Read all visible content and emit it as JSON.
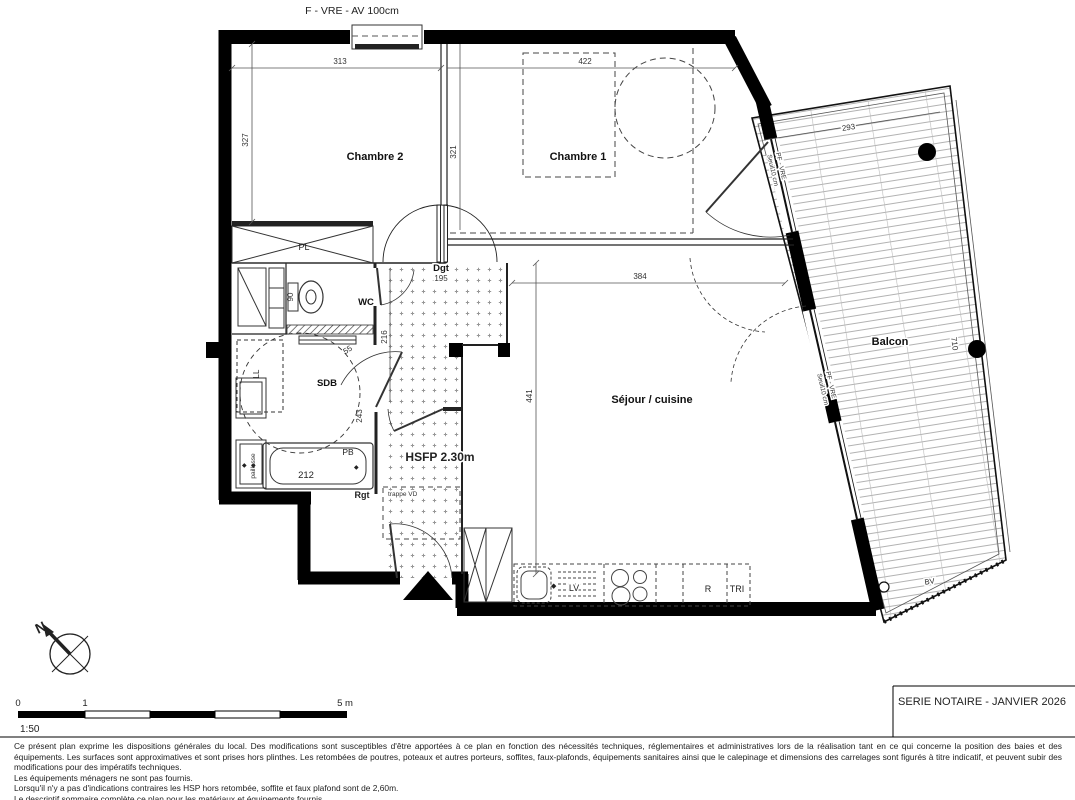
{
  "plan": {
    "window_label": "F - VRE - AV 100cm",
    "rooms": {
      "chambre2": "Chambre 2",
      "chambre1": "Chambre 1",
      "wc": "WC",
      "sdb": "SDB",
      "sejour": "Séjour / cuisine",
      "balcon": "Balcon",
      "dgt": "Dgt",
      "hsfp": "HSFP 2.30m"
    },
    "dims": {
      "d313": "313",
      "d422": "422",
      "d327": "327",
      "d321": "321",
      "d384": "384",
      "d441": "441",
      "d195": "195",
      "d90": "90",
      "d55": "55",
      "d216": "216",
      "d243": "243",
      "d212": "212",
      "d293": "293",
      "d710": "710"
    },
    "annotations": {
      "pl": "PL",
      "ll": "LL",
      "pb": "PB",
      "rgt": "Rgt",
      "paillasse": "paillasse",
      "trappe_vd": "trappe VD",
      "lv": "LV",
      "r": "R",
      "tri": "TRI",
      "bv": "BV",
      "pf_vre": "PF - VRE",
      "seuil": "Seuil10 cm"
    }
  },
  "footer": {
    "north_label": "N",
    "scale": {
      "t0": "0",
      "t1": "1",
      "t5": "5 m",
      "ratio": "1:50"
    },
    "series_label": "SERIE NOTAIRE - JANVIER 2026",
    "notes": [
      "Ce présent plan exprime les dispositions générales du local. Des modifications sont susceptibles d'être apportées à ce plan en fonction des nécessités techniques, réglementaires et administratives lors de la réalisation tant en ce qui concerne la position des baies et des équipements. Les surfaces sont approximatives et sont prises hors plinthes. Les retombées de poutres, poteaux et autres porteurs, soffites, faux-plafonds, équipements sanitaires ainsi que le calepinage et dimensions des carrelages sont figurés à titre indicatif, et peuvent subir des modifications pour des impératifs techniques.",
      "Les équipements ménagers ne sont pas fournis.",
      "Lorsqu'il n'y a pas d'indications contraires les HSP hors retombée, soffite et faux plafond sont de 2,60m.",
      "Le descriptif sommaire complète ce plan pour les matériaux et équipements fournis"
    ]
  }
}
